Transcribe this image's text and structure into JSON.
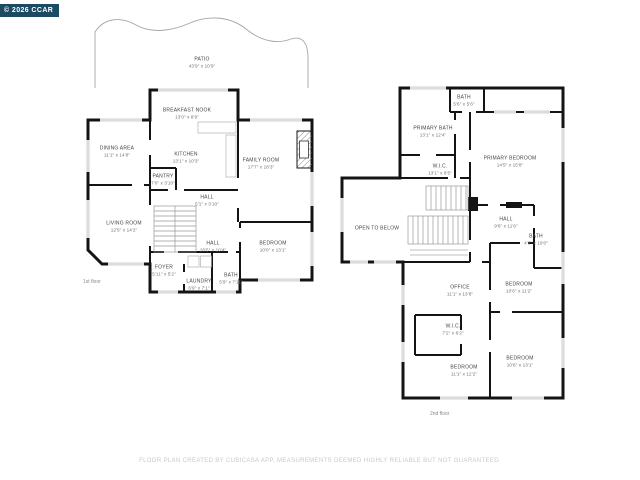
{
  "meta": {
    "copyright": "© 2026 CCAR",
    "footer": "FLOOR PLAN CREATED BY CUBICASA APP. MEASUREMENTS DEEMED HIGHLY RELIABLE BUT NOT GUARANTEED.",
    "badge_bg": "#1B4A63",
    "wall_color": "#141414",
    "window_color": "#DCDCDC",
    "label_color": "#454545"
  },
  "floor1": {
    "label": "1st floor",
    "rooms": [
      {
        "name": "PATIO",
        "dims": "43'9\" x 10'9\""
      },
      {
        "name": "BREAKFAST NOOK",
        "dims": "13'0\" x 8'9\""
      },
      {
        "name": "DINING AREA",
        "dims": "11'1\" x 14'8\""
      },
      {
        "name": "KITCHEN",
        "dims": "13'1\" x 10'3\""
      },
      {
        "name": "PANTRY",
        "dims": "7'0\" x 3'10\""
      },
      {
        "name": "FAMILY ROOM",
        "dims": "17'7\" x 18'3\""
      },
      {
        "name": "HALL",
        "dims": "5'1\" x 3'10\""
      },
      {
        "name": "LIVING ROOM",
        "dims": "12'5\" x 14'2\""
      },
      {
        "name": "HALL",
        "dims": "16'5\" x 10'4\""
      },
      {
        "name": "FOYER",
        "dims": "5'11\" x 5'2\""
      },
      {
        "name": "LAUNDRY",
        "dims": "6'9\" x 7'1\""
      },
      {
        "name": "BATH",
        "dims": "5'9\" x 7'11\""
      },
      {
        "name": "BEDROOM",
        "dims": "10'0\" x 13'1\""
      }
    ]
  },
  "floor2": {
    "label": "2nd floor",
    "rooms": [
      {
        "name": "BATH",
        "dims": "5'6\" x 5'6\""
      },
      {
        "name": "PRIMARY BATH",
        "dims": "13'1\" x 12'4\""
      },
      {
        "name": "PRIMARY BEDROOM",
        "dims": "14'5\" x 15'8\""
      },
      {
        "name": "W.I.C.",
        "dims": "13'1\" x 8'5\""
      },
      {
        "name": "OPEN TO BELOW",
        "dims": ""
      },
      {
        "name": "HALL",
        "dims": "9'6\" x 11'6\""
      },
      {
        "name": "BATH",
        "dims": "4'6\" x 10'0\""
      },
      {
        "name": "OFFICE",
        "dims": "11'1\" x 13'8\""
      },
      {
        "name": "BEDROOM",
        "dims": "10'6\" x 11'2\""
      },
      {
        "name": "W.I.C.",
        "dims": "7'2\" x 6'2\""
      },
      {
        "name": "BEDROOM",
        "dims": "11'1\" x 12'2\""
      },
      {
        "name": "BEDROOM",
        "dims": "10'6\" x 13'1\""
      }
    ]
  }
}
